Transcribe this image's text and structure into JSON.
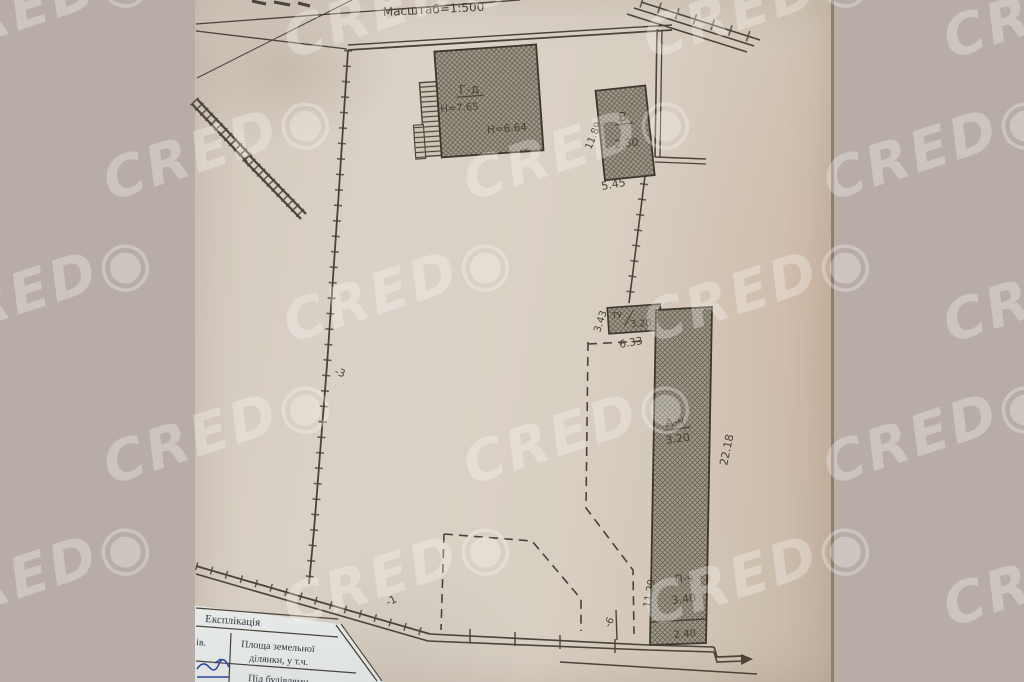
{
  "watermark": {
    "text": "CRED",
    "logo": "◉"
  },
  "plan": {
    "scale_label": "Масштаб=1:500",
    "buildings": {
      "main": {
        "label": "Г-д",
        "height_1": "Н=7.65",
        "height_2": "Н=6.64"
      },
      "v": {
        "label": "В",
        "value": "2.30",
        "dim_left": "11.89",
        "dim_bottom": "5.45"
      },
      "tu": {
        "label": "ТУ",
        "value": "3.20",
        "dim_bottom": "6.33",
        "dim_left": "3.43"
      },
      "long_upper": {
        "label": "А-ч",
        "value": "3.20",
        "dim_right": "22.18"
      },
      "long_lower": {
        "label": "П-ч",
        "value": "3.40",
        "edge_value": "2.40",
        "dim_left": "11.29"
      }
    },
    "point_labels": {
      "p3": "-3",
      "p1": "-1",
      "p6": "-6"
    }
  },
  "table": {
    "title": "Експлікація",
    "col_header_partial": "ів.",
    "area_line1": "Площа земельної",
    "area_line2": "ділянки, у т.ч.",
    "under_buildings": "Під будівлями"
  }
}
